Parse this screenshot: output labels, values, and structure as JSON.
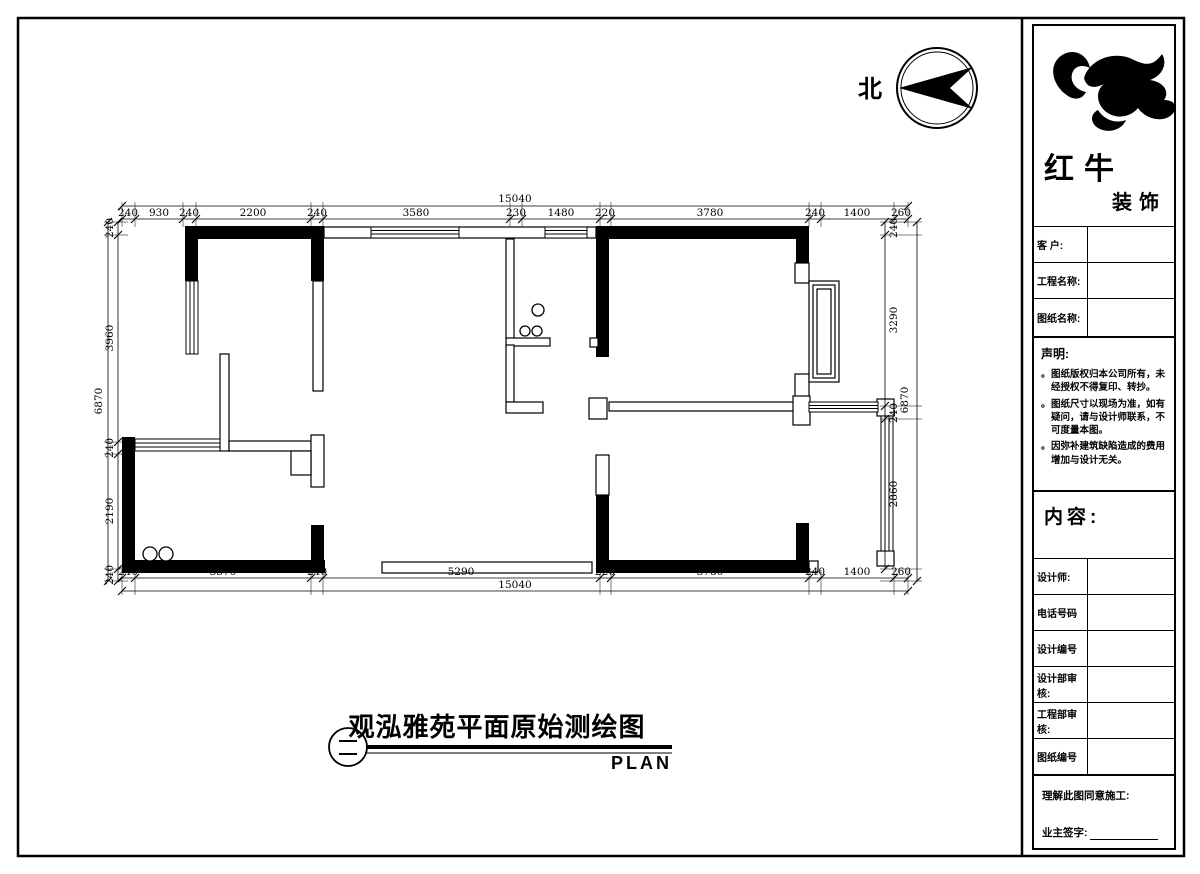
{
  "north": {
    "label": "北"
  },
  "logo": {
    "name_top": "红牛",
    "name_bottom": "装饰"
  },
  "title_block": {
    "customer_label": "客 户:",
    "project_label": "工程名称:",
    "sheet_label": "图纸名称:",
    "statement": {
      "heading": "声明:",
      "bullet": "。",
      "items": [
        "图纸版权归本公司所有，未经授权不得复印、转抄。",
        "图纸尺寸以现场为准，如有疑问，请与设计师联系，不可度量本图。",
        "因弥补建筑缺陷造成的费用增加与设计无关。"
      ]
    },
    "content_label": "内容:",
    "designer_label": "设计师:",
    "phone_label": "电话号码",
    "design_no_label": "设计编号",
    "design_review_label": "设计部审核:",
    "engineering_review_label": "工程部审核:",
    "sheet_no_label": "图纸编号",
    "agreement_label": "理解此图同意施工:",
    "owner_sign_label": "业主签字:"
  },
  "drawing_title": {
    "text": "观泓雅苑平面原始测绘图",
    "plan_label": "PLAN"
  },
  "plan": {
    "dims_top_total": "15040",
    "dims_top": [
      "240",
      "930",
      "240",
      "2200",
      "240",
      "3580",
      "230",
      "1480",
      "220",
      "3780",
      "240",
      "1400",
      "260"
    ],
    "dims_bottom_total": "15040",
    "dims_bottom": [
      "240",
      "3370",
      "240",
      "5290",
      "220",
      "3780",
      "240",
      "1400",
      "260"
    ],
    "dims_left_total": "6870",
    "dims_left": [
      "240",
      "3960",
      "240",
      "2190",
      "240"
    ],
    "dims_right_total": "6870",
    "dims_right": [
      "240",
      "3290",
      "240",
      "2860"
    ]
  }
}
